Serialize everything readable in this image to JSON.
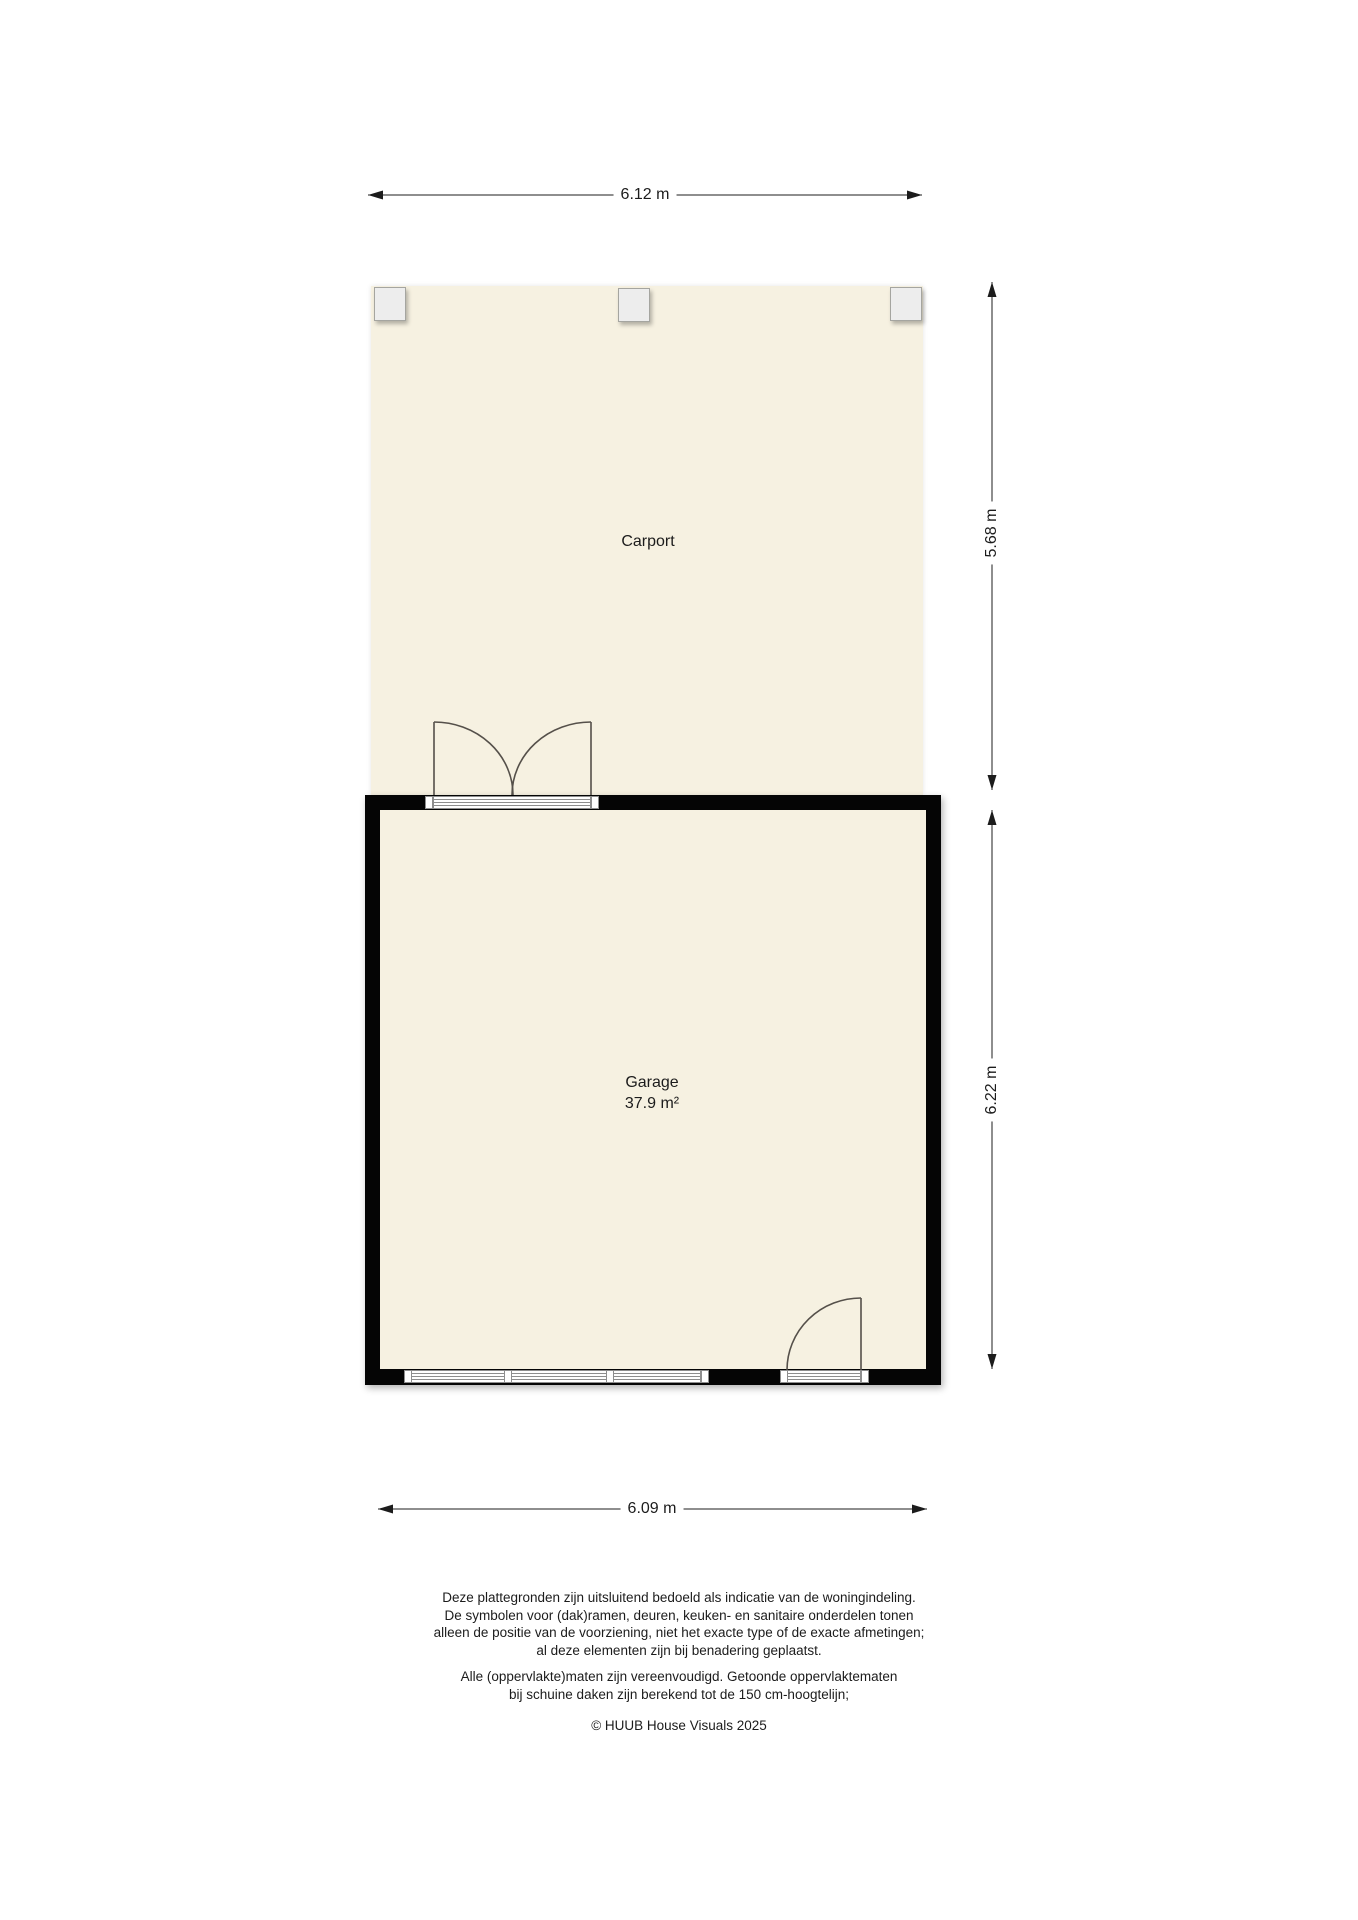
{
  "plan": {
    "carport": {
      "label": "Carport"
    },
    "garage": {
      "label": "Garage",
      "area": "37.9 m²"
    },
    "colors": {
      "floor": "#f6f1e1",
      "wall": "#050505",
      "post_fill": "#ededed",
      "glazing_line": "#8e8e8e",
      "door_swing": "#55504a",
      "dimension": "#1c1c1c"
    }
  },
  "dimensions": {
    "carport_width": "6.12 m",
    "carport_depth": "5.68 m",
    "garage_depth": "6.22 m",
    "garage_width": "6.09 m"
  },
  "footer": {
    "disclaimer1": {
      "lines": [
        "Deze plattegronden zijn uitsluitend bedoeld als indicatie van de woningindeling.",
        "De symbolen voor (dak)ramen, deuren, keuken- en sanitaire onderdelen tonen",
        "alleen de positie van de voorziening, niet het exacte type of de exacte afmetingen;",
        "al deze elementen zijn bij benadering geplaatst."
      ]
    },
    "disclaimer2": {
      "lines": [
        "Alle (oppervlakte)maten zijn vereenvoudigd. Getoonde oppervlaktematen",
        "bij schuine daken zijn berekend tot de 150 cm-hoogtelijn;"
      ]
    },
    "copyright": "© HUUB House Visuals 2025"
  }
}
